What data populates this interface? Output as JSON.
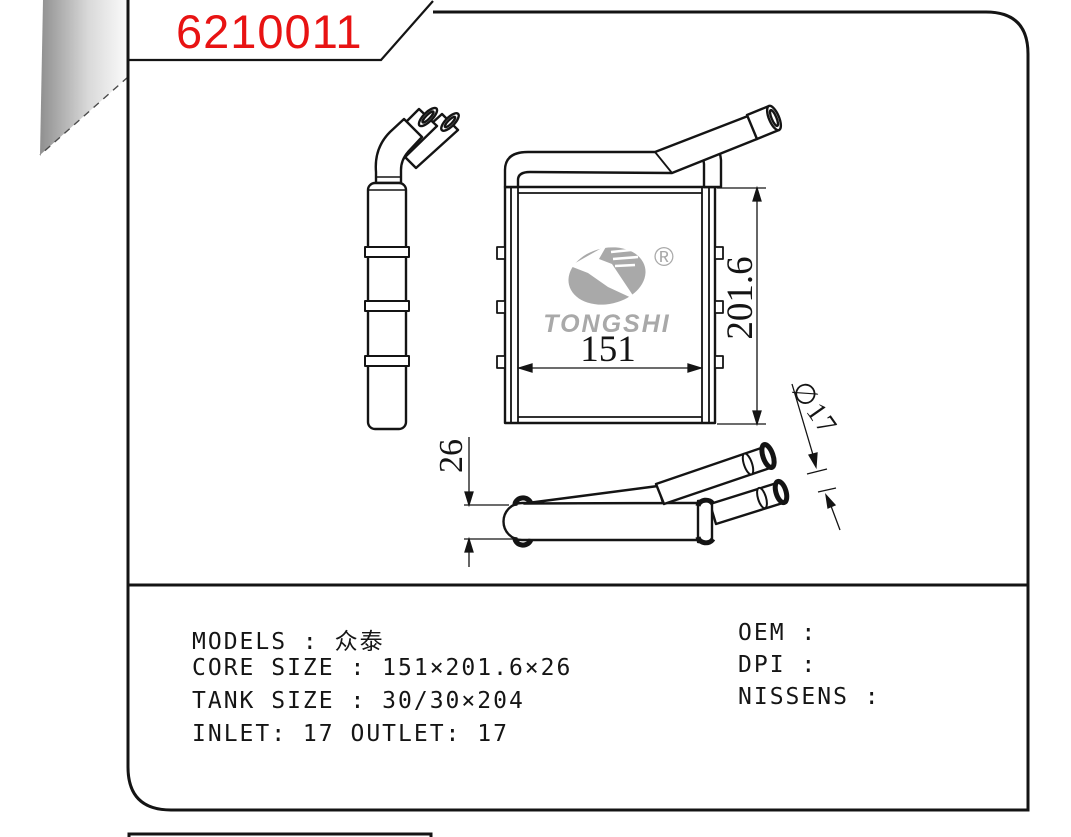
{
  "title": {
    "part_number": "6210011",
    "color": "#e81313"
  },
  "logo": {
    "brand": "TONGSHI",
    "registered_mark": "®",
    "color": "#a9a9a9"
  },
  "drawing": {
    "dims": {
      "width": "151",
      "height": "201.6",
      "depth": "26",
      "pipe_diameter": "∅17"
    },
    "line_color": "#141414"
  },
  "specs": {
    "left": [
      "MODELS :  众泰",
      "CORE SIZE : 151×201.6×26",
      "TANK SIZE : 30/30×204",
      "INLET: 17  OUTLET: 17"
    ],
    "right": [
      "OEM :",
      "DPI :",
      "NISSENS :"
    ]
  }
}
